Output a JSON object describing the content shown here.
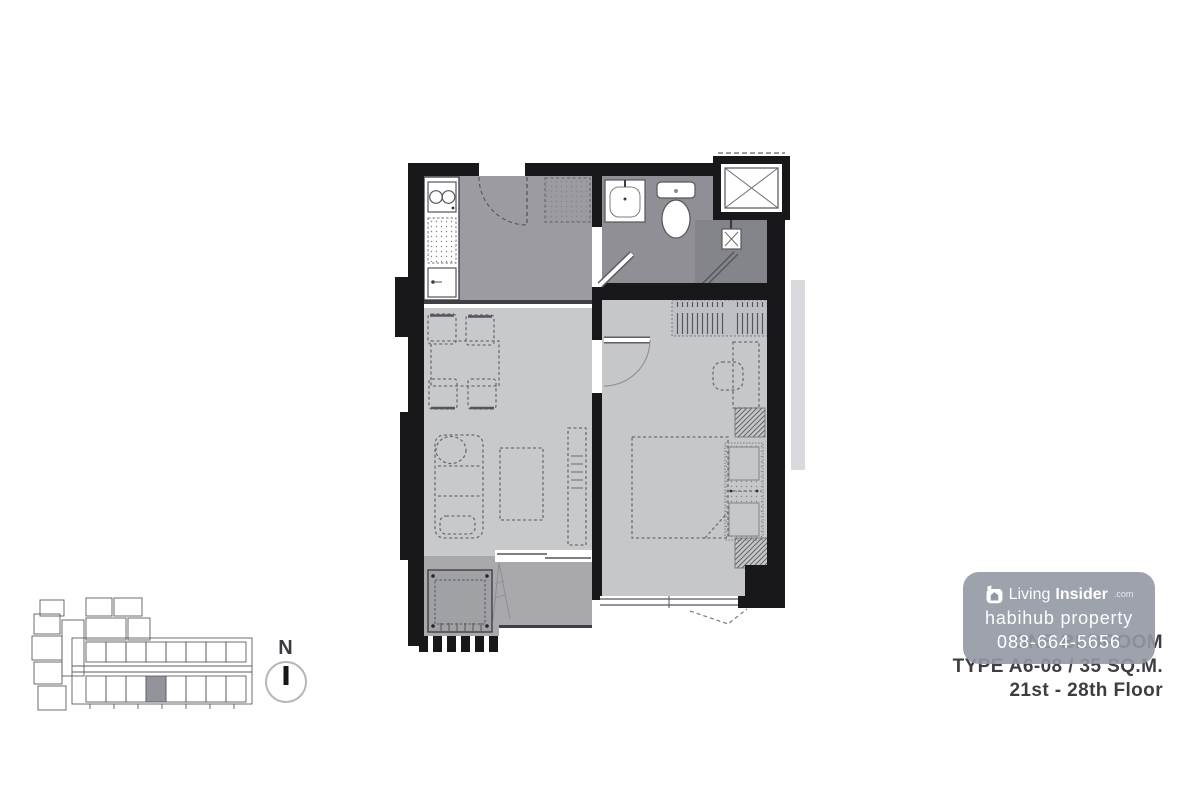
{
  "page": {
    "background": "#ffffff"
  },
  "floorplan": {
    "description": "one-bedroom condominium unit floor plan",
    "wall_color": "#18181b",
    "floor_colors": {
      "entry_kitchen_hall": "#9b9ba1",
      "bathroom": "#8f8f95",
      "shower": "#84848b",
      "living_dining": "#c8c9cb",
      "bedroom": "#c6c7c9",
      "balcony": "#a9a9ad"
    }
  },
  "key_plan": {
    "line_color": "#55555b",
    "highlight_unit_color": "#8e8e96"
  },
  "compass": {
    "label": "N"
  },
  "watermark": {
    "brand_light": "Living",
    "brand_bold": "Insider",
    "brand_tld": ".com",
    "line2": "habihub property",
    "phone": "088-664-5656",
    "background": "#9398a4",
    "text_color": "#ffffff"
  },
  "title_block": {
    "line1": "ONE BEDROOM",
    "line2": "TYPE A6-08 / 35 SQ.M.",
    "line3": "21st - 28th Floor",
    "text_color": "#3d3d43"
  }
}
